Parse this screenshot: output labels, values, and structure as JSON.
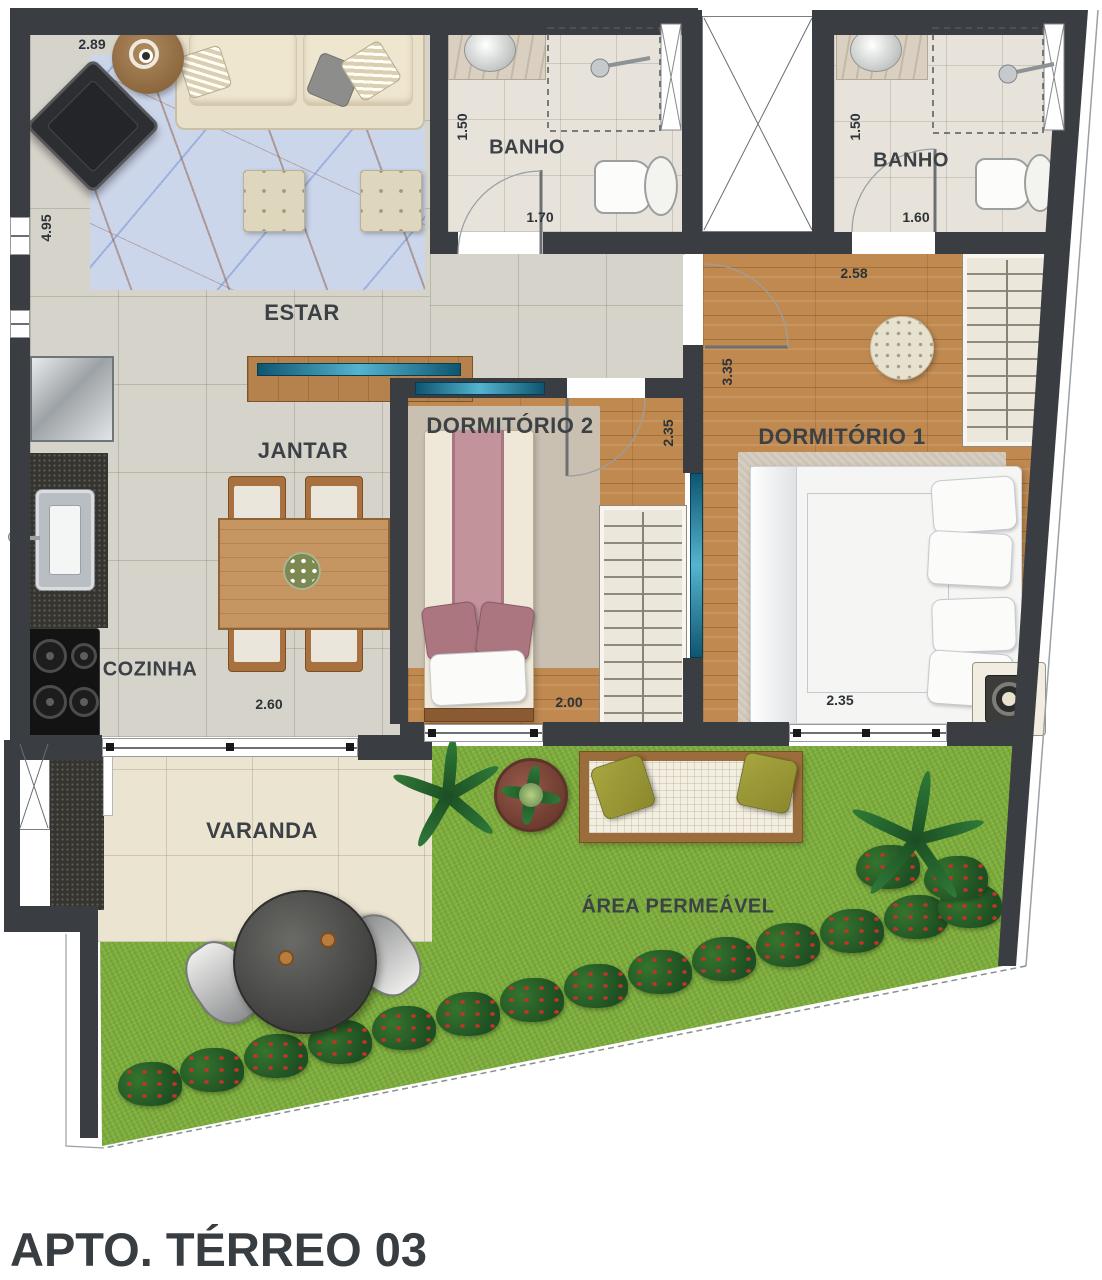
{
  "title": "APTO. TÉRREO 03",
  "rooms": {
    "estar": {
      "label": "ESTAR",
      "dim_width": "2.89",
      "dim_height": "4.95"
    },
    "jantar": {
      "label": "JANTAR"
    },
    "cozinha": {
      "label": "COZINHA",
      "dim_width": "2.60"
    },
    "banho1": {
      "label": "BANHO",
      "dim_height": "1.50",
      "dim_width": "1.70"
    },
    "banho2": {
      "label": "BANHO",
      "dim_height": "1.50",
      "dim_width": "1.60"
    },
    "dormitorio1": {
      "label": "DORMITÓRIO 1",
      "dim_top": "2.58",
      "dim_height": "3.35",
      "dim_bottom": "2.35"
    },
    "dormitorio2": {
      "label": "DORMITÓRIO 2",
      "dim_height": "2.35",
      "dim_bottom": "2.00"
    },
    "varanda": {
      "label": "VARANDA"
    },
    "garden": {
      "label": "ÁREA PERMEÁVEL"
    }
  },
  "colors": {
    "wall": "#3a3d42",
    "tile_floor": "#d6d3ca",
    "wood_floor": "#bf8950",
    "grass": "#7fae3e",
    "window_glass": "#54b4cf",
    "label_text": "#3c4146"
  }
}
